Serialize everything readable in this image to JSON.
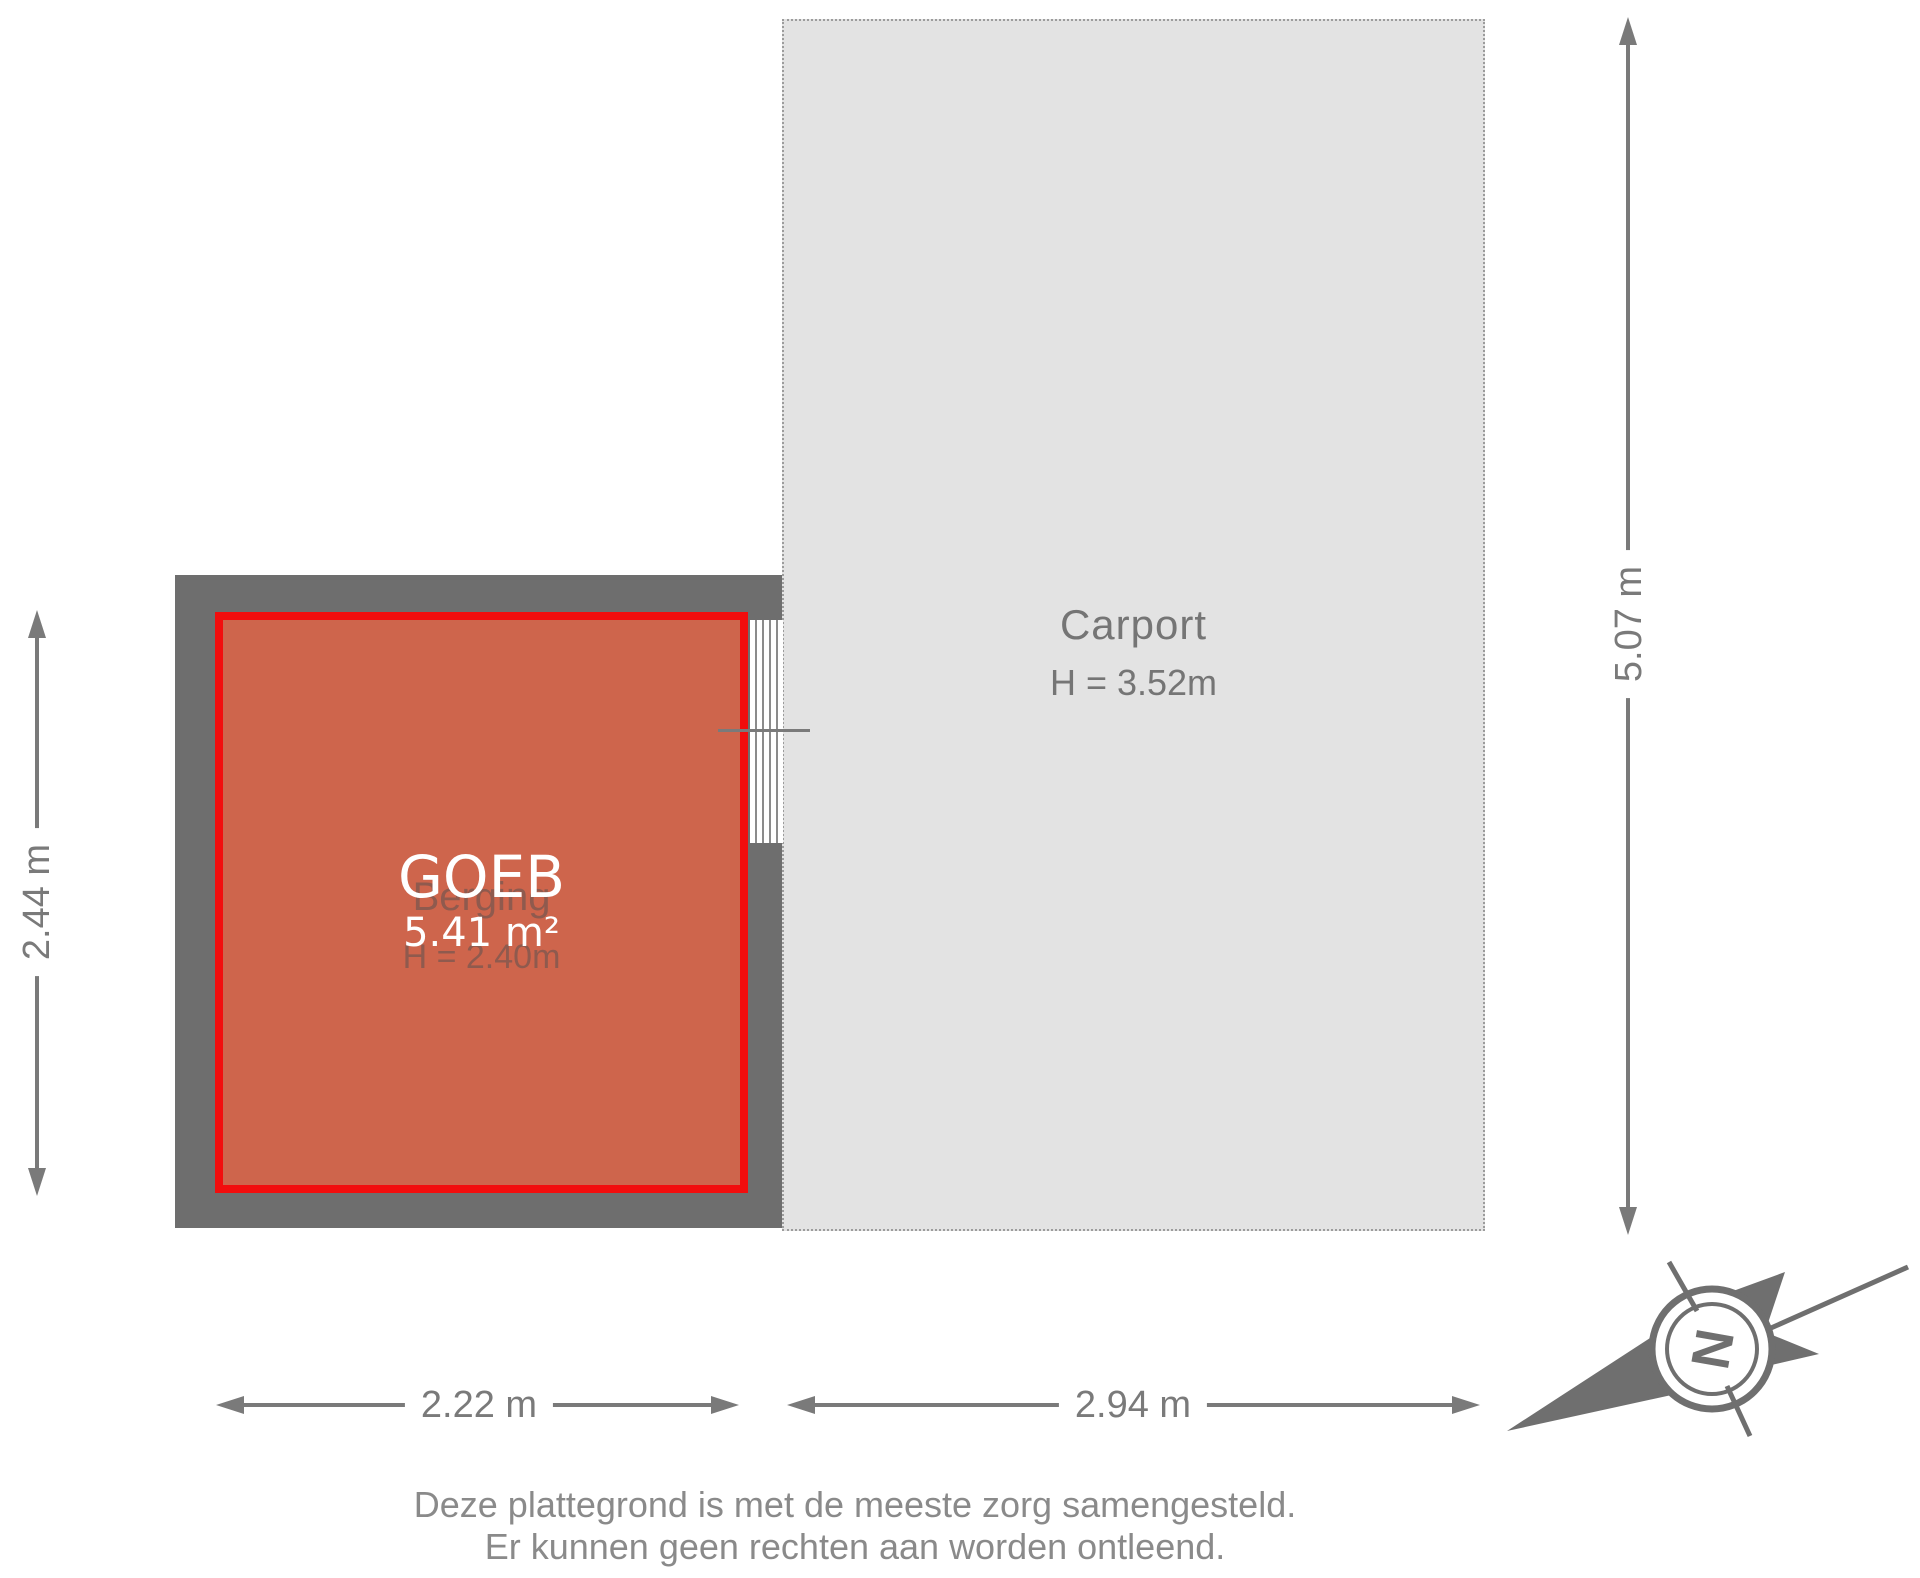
{
  "room": {
    "overlay_label": "GOEB",
    "area_label": "5.41 m²",
    "name_label": "Berging",
    "height_label": "H = 2.40m"
  },
  "carport": {
    "name_label": "Carport",
    "height_label": "H = 3.52m"
  },
  "dimensions": {
    "room_height": "2.44 m",
    "total_height": "5.07 m",
    "room_width": "2.22 m",
    "carport_width": "2.94 m"
  },
  "compass": {
    "north_label": "N"
  },
  "disclaimer": {
    "line1": "Deze plattegrond is met de meeste zorg samengesteld.",
    "line2": "Er kunnen geen rechten aan worden ontleend."
  },
  "colors": {
    "wall": "#6E6E6E",
    "room_fill": "#CE654C",
    "room_outline": "#F20D0D",
    "carport_fill": "#E3E3E3",
    "carport_border": "#9C9C9C",
    "dim_gray": "#7A7A7A",
    "label_gray": "#757575",
    "footer_gray": "#8A8A8A",
    "compass_gray": "#6F6F6F"
  }
}
